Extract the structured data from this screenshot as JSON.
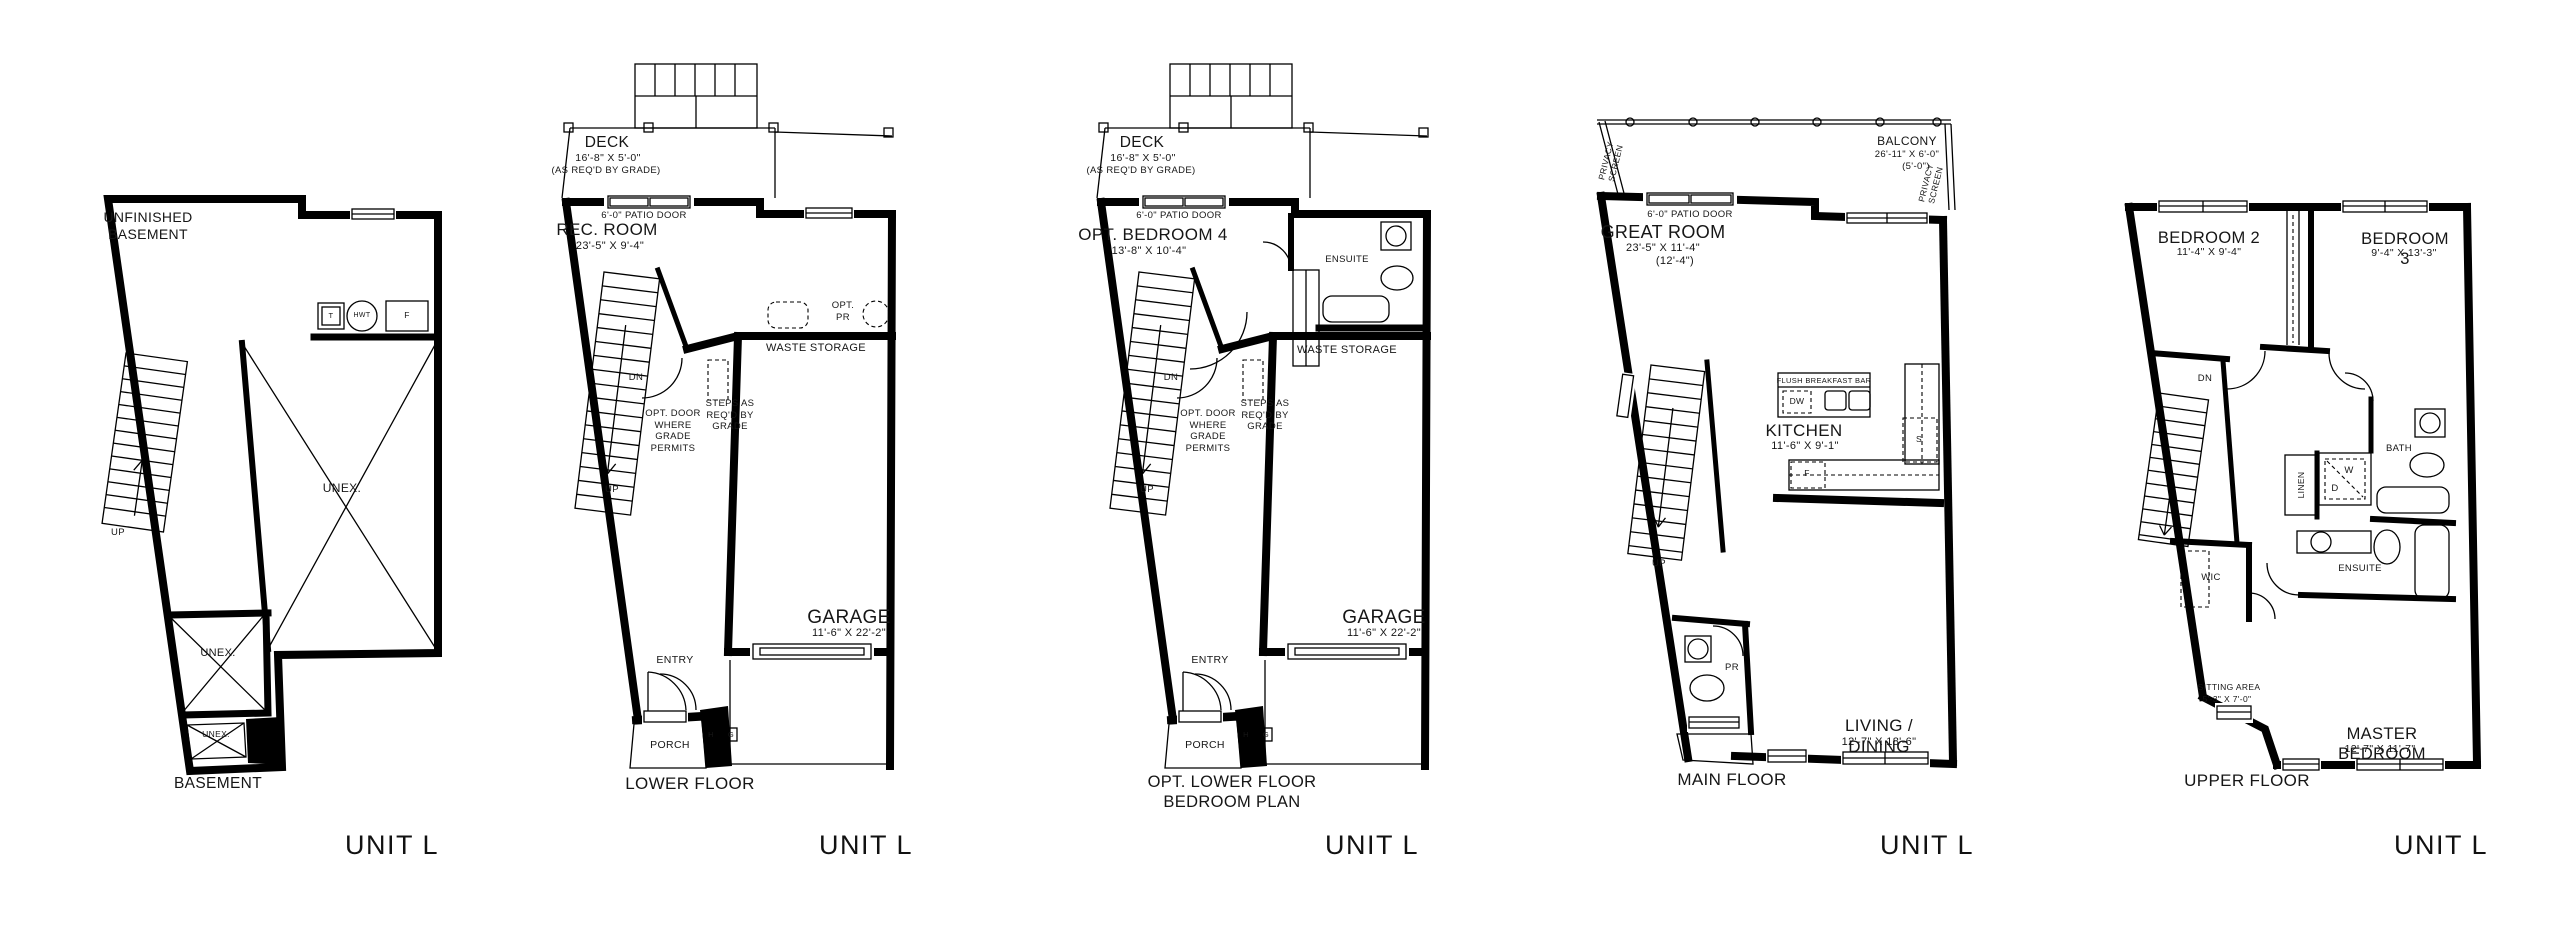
{
  "sheet": {
    "background": "#ffffff",
    "line_color": "#000000"
  },
  "unit_label": "UNIT L",
  "plans": {
    "basement": {
      "floor_label": "BASEMENT",
      "room": "UNFINISHED\nBASEMENT",
      "unex_large": "UNEX.",
      "unex_mid": "UNEX.",
      "unex_small": "UNEX.",
      "up": "UP",
      "tank": "T",
      "water_heater": "HWT",
      "furnace": "F"
    },
    "lower": {
      "floor_label": "LOWER FLOOR",
      "deck": "DECK",
      "deck_dim": "16'-8\" X 5'-0\"",
      "deck_note": "(AS REQ'D BY GRADE)",
      "patio_door": "6'-0\" PATIO DOOR",
      "room": "REC. ROOM",
      "room_dim": "23'-5\" X 9'-4\"",
      "opt_pr": "OPT.\nPR",
      "waste_storage": "WASTE STORAGE",
      "dn": "DN",
      "up": "UP",
      "opt_door_note": "OPT. DOOR\nWHERE\nGRADE\nPERMITS",
      "steps_note": "STEPS AS\nREQ'D BY\nGRADE",
      "garage": "GARAGE",
      "garage_dim": "11'-6\" X 22'-2\"",
      "entry": "ENTRY",
      "porch": "PORCH",
      "meter_h": "H",
      "meter_g": "G"
    },
    "opt_lower": {
      "floor_label": "OPT. LOWER FLOOR\nBEDROOM PLAN",
      "deck": "DECK",
      "deck_dim": "16'-8\" X 5'-0\"",
      "deck_note": "(AS REQ'D BY GRADE)",
      "patio_door": "6'-0\" PATIO DOOR",
      "room": "OPT. BEDROOM 4",
      "room_dim": "13'-8\" X 10'-4\"",
      "ensuite": "ENSUITE",
      "waste_storage": "WASTE STORAGE",
      "dn": "DN",
      "up": "UP",
      "opt_door_note": "OPT. DOOR\nWHERE\nGRADE\nPERMITS",
      "steps_note": "STEPS AS\nREQ'D BY\nGRADE",
      "garage": "GARAGE",
      "garage_dim": "11'-6\" X 22'-2\"",
      "entry": "ENTRY",
      "porch": "PORCH",
      "meter_h": "H",
      "meter_g": "G"
    },
    "main": {
      "floor_label": "MAIN FLOOR",
      "privacy_screen": "PRIVACY\nSCREEN",
      "balcony": "BALCONY",
      "balcony_dim": "26'-11\" X 6'-0\"",
      "balcony_dim2": "(5'-0\")",
      "patio_door": "6'-0\" PATIO DOOR",
      "great_room": "GREAT ROOM",
      "great_room_dim": "23'-5\" X 11'-4\"",
      "great_room_dim2": "(12'-4\")",
      "breakfast_bar": "FLUSH BREAKFAST BAR",
      "dw": "DW",
      "kitchen": "KITCHEN",
      "kitchen_dim": "11'-6\" X 9'-1\"",
      "stove": "S",
      "fridge": "F",
      "up": "UP",
      "pr": "PR",
      "living_dining": "LIVING / DINING",
      "living_dining_dim": "12'-7\" X 18'-6\""
    },
    "upper": {
      "floor_label": "UPPER FLOOR",
      "bedroom2": "BEDROOM 2",
      "bedroom2_dim": "11'-4\" X 9'-4\"",
      "bedroom3": "BEDROOM 3",
      "bedroom3_dim": "9'-4\" X 13'-3\"",
      "dn": "DN",
      "linen": "LINEN",
      "washer": "W",
      "dryer": "D",
      "bath": "BATH",
      "ensuite": "ENSUITE",
      "wic": "WIC",
      "sitting_area": "SITTING AREA",
      "sitting_area_dim": "5'-3\" X 7'-0\"",
      "master": "MASTER BEDROOM",
      "master_dim": "12'-7\" X 11'-7\""
    }
  }
}
